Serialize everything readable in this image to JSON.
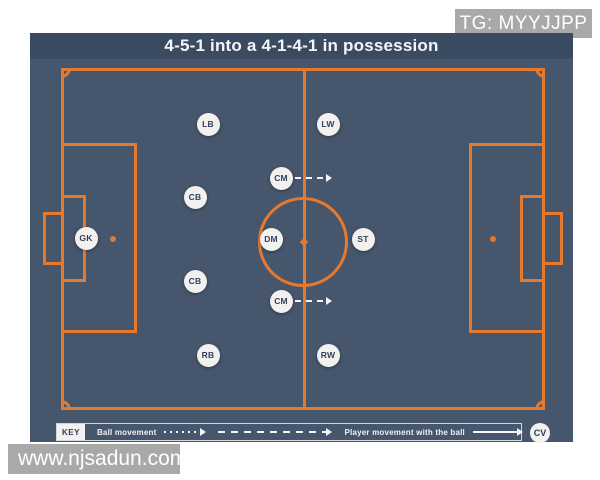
{
  "overlays": {
    "tg_label": "TG: MYYJJPP",
    "watermark": "www.njsadun.com"
  },
  "diagram": {
    "title": "4-5-1 into a 4-1-4-1 in possession",
    "badge": "CV",
    "key": {
      "label": "KEY",
      "items": [
        {
          "label": "Ball movement",
          "style": "dotted"
        },
        {
          "label": "",
          "style": "dashed"
        },
        {
          "label": "Player movement with the ball",
          "style": "solid"
        }
      ]
    },
    "players": [
      {
        "label": "GK",
        "x": 56,
        "y": 205,
        "arrow": false
      },
      {
        "label": "LB",
        "x": 178,
        "y": 91,
        "arrow": false
      },
      {
        "label": "CB",
        "x": 165,
        "y": 164,
        "arrow": false
      },
      {
        "label": "CB",
        "x": 165,
        "y": 248,
        "arrow": false
      },
      {
        "label": "RB",
        "x": 178,
        "y": 322,
        "arrow": false
      },
      {
        "label": "LW",
        "x": 298,
        "y": 91,
        "arrow": false
      },
      {
        "label": "CM",
        "x": 251,
        "y": 145,
        "arrow": true
      },
      {
        "label": "DM",
        "x": 241,
        "y": 206,
        "arrow": false
      },
      {
        "label": "CM",
        "x": 251,
        "y": 268,
        "arrow": true
      },
      {
        "label": "RW",
        "x": 298,
        "y": 322,
        "arrow": false
      },
      {
        "label": "ST",
        "x": 333,
        "y": 206,
        "arrow": false
      }
    ],
    "colors": {
      "pitch_line": "#e5792e",
      "board_bg": "#46566c",
      "title_bar": "#3a4a60",
      "player_circle": "#f2f1ef",
      "player_text": "#32415a",
      "overlay_gray": "#a9a9a9",
      "arrow_white": "#f5f5f5"
    }
  }
}
